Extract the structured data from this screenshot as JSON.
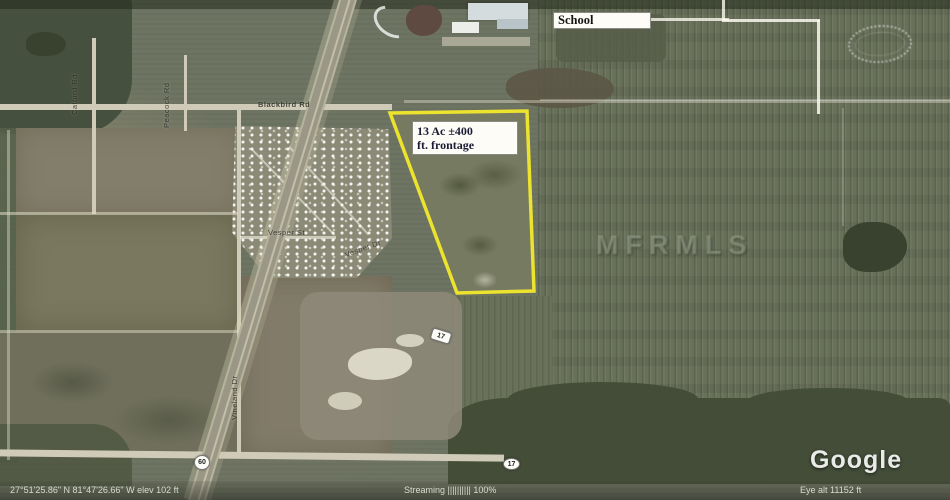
{
  "labels": {
    "school": "School",
    "parcel_line1": "13 Ac ±400",
    "parcel_line2": "ft. frontage",
    "watermark": "MFRMLS",
    "google": "Google"
  },
  "shields": {
    "highway_mid": "17",
    "highway_bottom": "17",
    "junction": "60"
  },
  "roads": {
    "blackbird": "Blackbird Rd",
    "catbird": "Catbird Rd",
    "peacock": "Peacock Rd",
    "vineland": "Vineland Dr",
    "vesper_st": "Vesper St",
    "vesper_dr": "Vesper Dr"
  },
  "status_bar": {
    "pointer": "27°51'25.86\" N   81°47'26.66\" W    elev  102 ft",
    "streaming": "Streaming |||||||||| 100%",
    "eye_alt": "Eye alt   11152 ft"
  },
  "colors": {
    "parcel_outline": "#ece32f",
    "grove_green": "#68705a",
    "label_text": "#1b1b34"
  }
}
